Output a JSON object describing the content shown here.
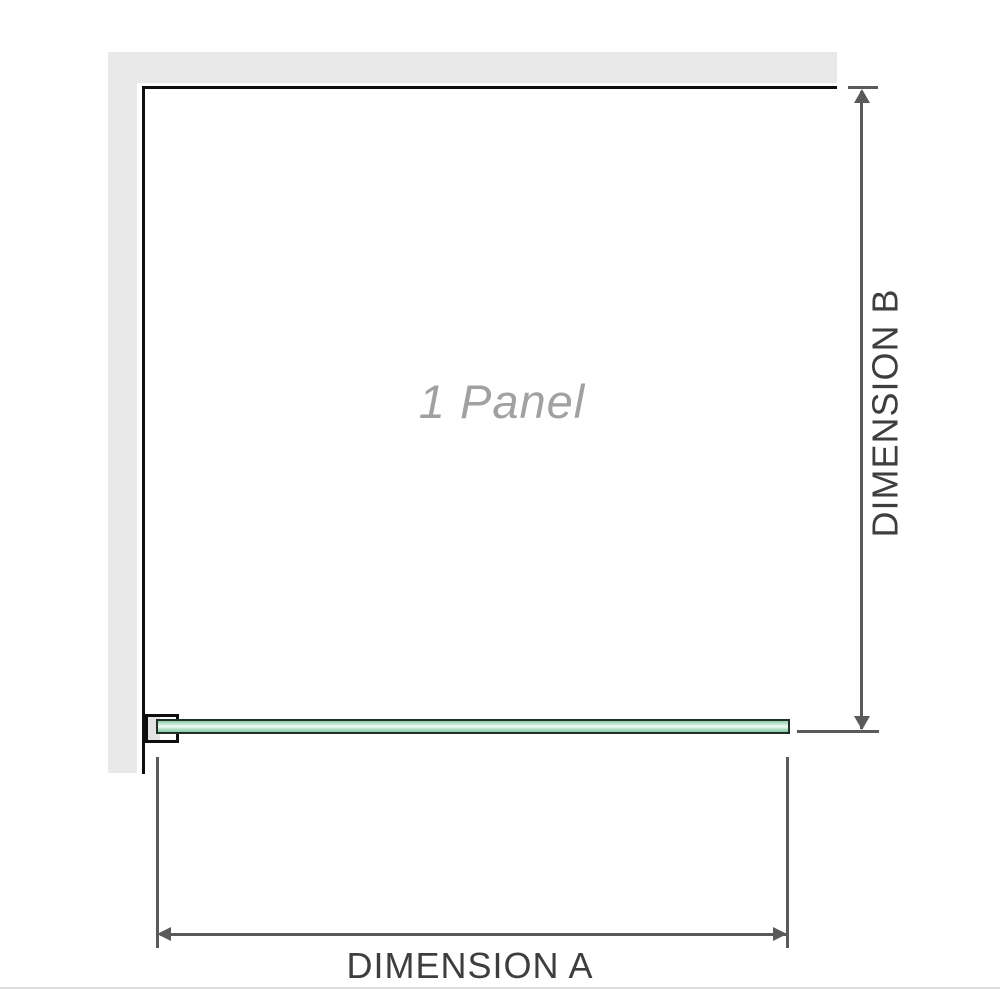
{
  "diagram": {
    "panel_label": "1 Panel",
    "dimension_a_label": "DIMENSION A",
    "dimension_b_label": "DIMENSION B"
  },
  "colors": {
    "wall": "#e9e9e9",
    "outline": "#0e0e0e",
    "dimension": "#5a5a5a",
    "dimension_text": "#3e3e3e",
    "panel_text": "#a1a1a1",
    "glass_border": "#223128",
    "glass_light": "#f5fcf8",
    "glass_mid": "#b5e0c8",
    "glass_dark": "#8fcba8",
    "bracket_fill": "#e3e3e3",
    "baseline": "#dcdcdc"
  }
}
